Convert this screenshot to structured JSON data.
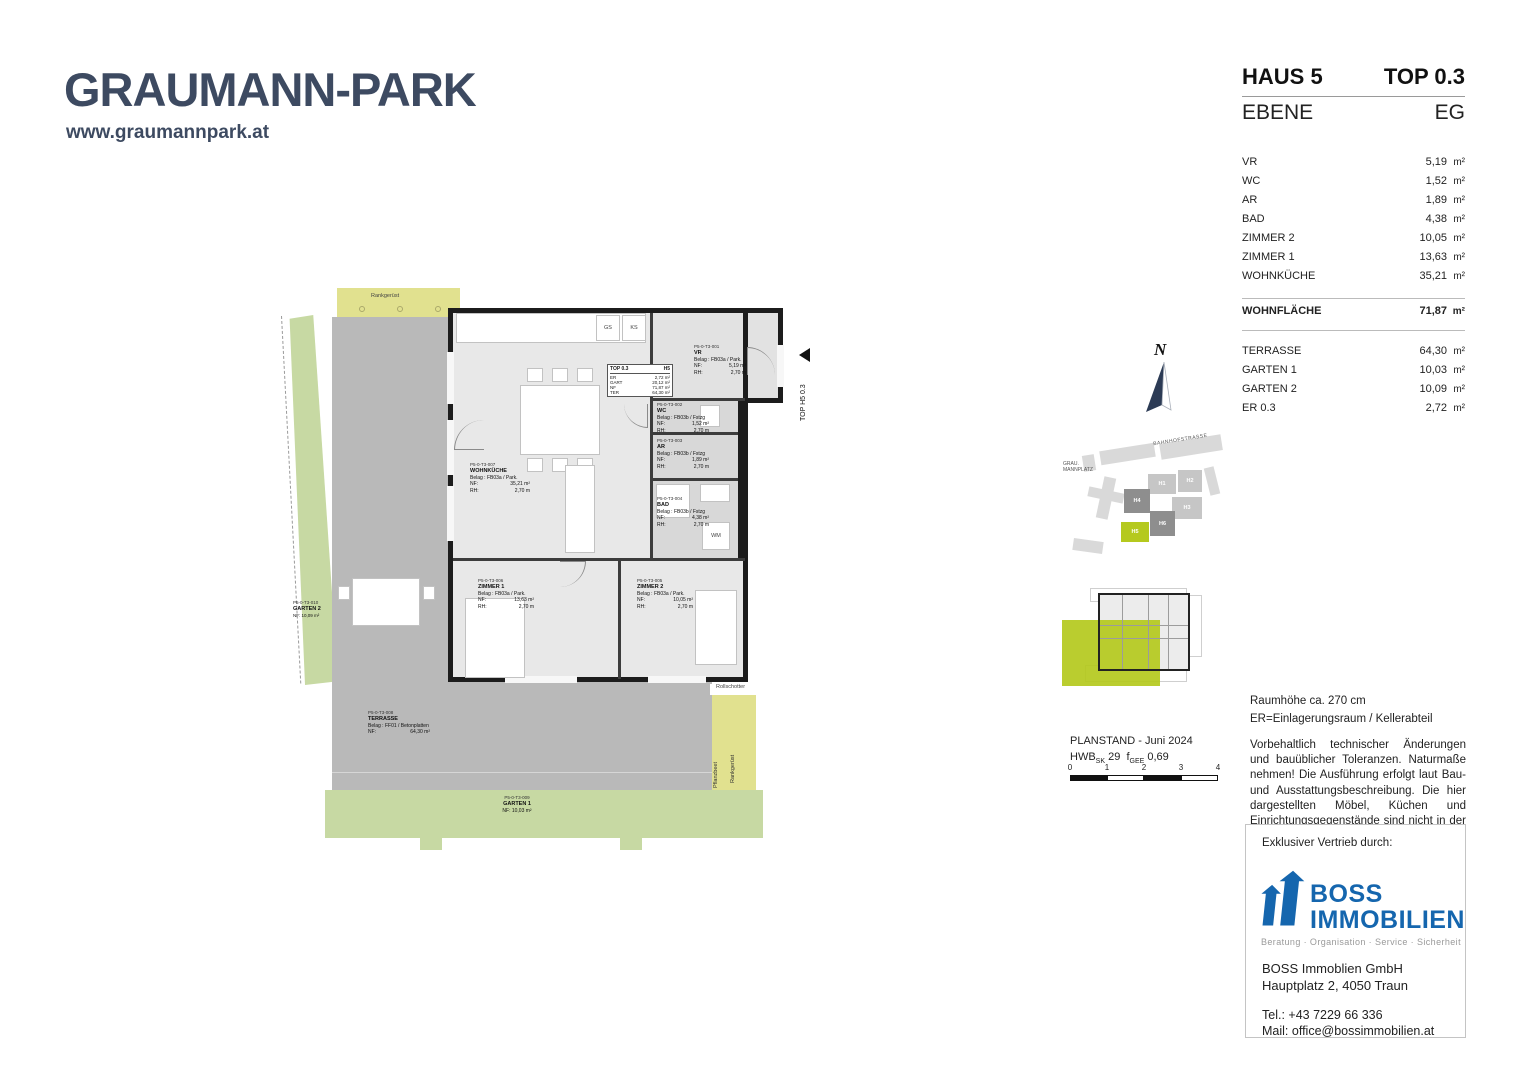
{
  "logo": {
    "title": "GRAUMANN-PARK",
    "website": "www.graumannpark.at"
  },
  "unit_header": {
    "haus": "HAUS 5",
    "top": "TOP 0.3",
    "level_label": "EBENE",
    "level_value": "EG"
  },
  "area_table": {
    "rooms": [
      {
        "label": "VR",
        "value": "5,19",
        "unit": "m²"
      },
      {
        "label": "WC",
        "value": "1,52",
        "unit": "m²"
      },
      {
        "label": "AR",
        "value": "1,89",
        "unit": "m²"
      },
      {
        "label": "BAD",
        "value": "4,38",
        "unit": "m²"
      },
      {
        "label": "ZIMMER 2",
        "value": "10,05",
        "unit": "m²"
      },
      {
        "label": "ZIMMER 1",
        "value": "13,63",
        "unit": "m²"
      },
      {
        "label": "WOHNKÜCHE",
        "value": "35,21",
        "unit": "m²"
      }
    ],
    "total": {
      "label": "WOHNFLÄCHE",
      "value": "71,87",
      "unit": "m²"
    },
    "outdoor": [
      {
        "label": "TERRASSE",
        "value": "64,30",
        "unit": "m²"
      },
      {
        "label": "GARTEN 1",
        "value": "10,03",
        "unit": "m²"
      },
      {
        "label": "GARTEN 2",
        "value": "10,09",
        "unit": "m²"
      },
      {
        "label": "ER 0.3",
        "value": "2,72",
        "unit": "m²"
      }
    ]
  },
  "floorplan": {
    "entry_label": "TOP H5 0.3",
    "info_box": {
      "title": "TOP 0.3",
      "haus": "H5",
      "rows": [
        {
          "k": "ER",
          "v": "2,72 m²"
        },
        {
          "k": "GART",
          "v": "20,12 m²"
        },
        {
          "k": "NF",
          "v": "71,87 m²"
        },
        {
          "k": "TER",
          "v": "64,30 m²"
        }
      ]
    },
    "labels": {
      "rankgeruest_top": "Rankgerüst",
      "rollschotter_top": "Rollschotter",
      "rollschotter_bottom": "Rollschotter",
      "rankgeruest_right": "Rankgerüst",
      "pflanzbeet": "Pflanzbeet",
      "gs": "GS",
      "ks": "KS",
      "wm": "WM",
      "mst": "MST EVT"
    },
    "rooms": {
      "vr": {
        "code": "P5-0-T3-001",
        "name": "VR",
        "belag": "Belag : FB03a / Park.",
        "nf_l": "NF:",
        "nf_v": "5,19 m²",
        "rh_l": "RH:",
        "rh_v": "2,70 m"
      },
      "wc": {
        "code": "P5-0-T3-002",
        "name": "WC",
        "belag": "Belag : FB03b / Fstzg",
        "nf_l": "NF:",
        "nf_v": "1,52 m²",
        "rh_l": "RH:",
        "rh_v": "2,70 m"
      },
      "ar": {
        "code": "P5-0-T3-003",
        "name": "AR",
        "belag": "Belag : FB03b / Fstzg",
        "nf_l": "NF:",
        "nf_v": "1,89 m²",
        "rh_l": "RH:",
        "rh_v": "2,70 m"
      },
      "bad": {
        "code": "P5-0-T3-004",
        "name": "BAD",
        "belag": "Belag : FB03b / Fstzg",
        "nf_l": "NF:",
        "nf_v": "4,38 m²",
        "rh_l": "RH:",
        "rh_v": "2,70 m"
      },
      "zimmer2": {
        "code": "P5-0-T3-005",
        "name": "ZIMMER 2",
        "belag": "Belag : FB03a / Park.",
        "nf_l": "NF:",
        "nf_v": "10,05 m²",
        "rh_l": "RH:",
        "rh_v": "2,70 m"
      },
      "zimmer1": {
        "code": "P5-0-T3-006",
        "name": "ZIMMER 1",
        "belag": "Belag : FB03a / Park.",
        "nf_l": "NF:",
        "nf_v": "13,63 m²",
        "rh_l": "RH:",
        "rh_v": "2,70 m"
      },
      "wohnkueche": {
        "code": "P5-0-T3-007",
        "name": "WOHNKÜCHE",
        "belag": "Belag : FB03a / Park.",
        "nf_l": "NF:",
        "nf_v": "35,21 m²",
        "rh_l": "RH:",
        "rh_v": "2,70 m"
      },
      "terrasse": {
        "code": "P5-0-T3-008",
        "name": "TERRASSE",
        "belag": "Belag : FF01 / Betonplatten",
        "nf_l": "NF:",
        "nf_v": "64,30 m²"
      },
      "garten1": {
        "code": "P5-0-T3-009",
        "name": "GARTEN 1",
        "nf": "NF: 10,03 m²"
      },
      "garten2": {
        "code": "P5-0-T3-010",
        "name": "GARTEN 2",
        "nf": "NF: 10,09 m²"
      }
    }
  },
  "compass": {
    "label": "N"
  },
  "site_plan": {
    "street": "BAHNHOFSTRASSE",
    "place_line1": "GRAU.",
    "place_line2": "MANNPLATZ",
    "buildings": {
      "h1": "H1",
      "h2": "H2",
      "h3": "H3",
      "h4": "H4",
      "h5": "H5",
      "h6": "H6"
    }
  },
  "planstand": {
    "line1": "PLANSTAND - Juni 2024",
    "hwb_prefix": "HWB",
    "hwb_sub": "SK",
    "hwb_value": "29",
    "f_prefix": "f",
    "f_sub": "GEE",
    "f_value": "0,69",
    "ticks": [
      "0",
      "1",
      "2",
      "3",
      "4"
    ]
  },
  "notes": {
    "line1": "Raumhöhe ca. 270 cm",
    "line2": "ER=Einlagerungsraum / Kellerabteil",
    "paragraph": "Vorbehaltlich technischer Änderungen und bauüblicher Toleranzen. Naturmaße nehmen! Die Ausführung erfolgt laut Bau- und Ausstattungsbeschreibung. Die hier dargestellten Möbel, Küchen und Einrichtungsgegenstände sind nicht in der Grundausstattung enthalten."
  },
  "vendor": {
    "heading": "Exklusiver Vertrieb durch:",
    "brand_line1": "BOSS",
    "brand_line2": "IMMOBILIEN",
    "tagline": "Beratung · Organisation · Service · Sicherheit",
    "company": "BOSS Immoblien GmbH",
    "address": "Hauptplatz 2, 4050 Traun",
    "tel": "Tel.: +43 7229 66 336",
    "mail": "Mail: office@bossimmobilien.at"
  }
}
